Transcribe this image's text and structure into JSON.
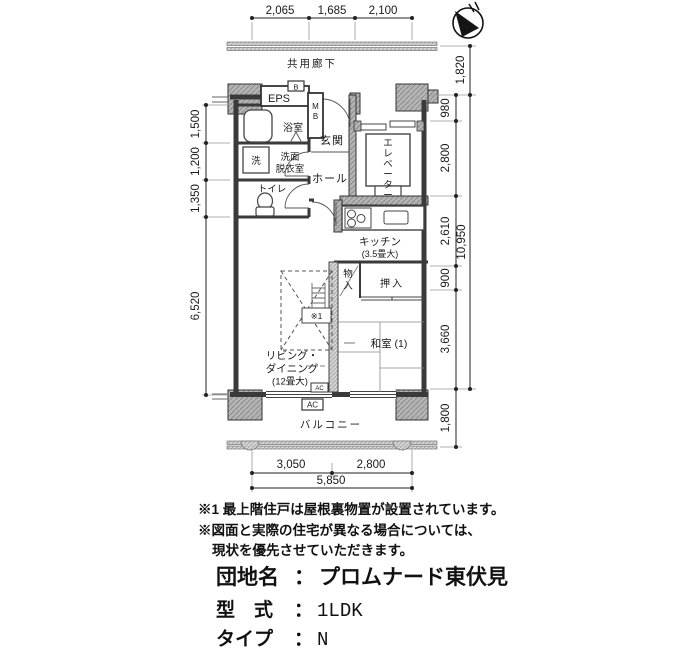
{
  "dims": {
    "top": [
      "2,065",
      "1,685",
      "2,100"
    ],
    "left": [
      "1,500",
      "1,200",
      "1,350",
      "6,520"
    ],
    "right_inner": [
      "980",
      "2,800",
      "2,610",
      "900",
      "3,660",
      "1,800"
    ],
    "right_outer": [
      "1,820",
      "10,950"
    ],
    "bottom": [
      "3,050",
      "2,800"
    ],
    "bottom_total": "5,850"
  },
  "plan": {
    "corridor": "共用廊下",
    "balcony": "バルコニー",
    "eps": "EPS",
    "meter_b": "B",
    "mb": "MB",
    "bath": "浴室",
    "wash_machine": "洗",
    "washroom": [
      "洗面",
      "脱衣室"
    ],
    "toilet": "トイレ",
    "entrance": "玄関",
    "hall": "ホール",
    "elevator": "エレベーター",
    "kitchen": "キッチン",
    "kitchen_size": "(3.5畳大)",
    "storage": "物入",
    "closet": "押入",
    "japanese_room": "和室 (1)",
    "living": [
      "リビング・",
      "ダイニング"
    ],
    "living_size": "(12畳大)",
    "ac": "AC",
    "note_ref": "※1"
  },
  "notes": [
    "※1 最上階住戸は屋根裏物置が設置されています。",
    "※図面と実際の住宅が異なる場合については、",
    "現状を優先させていただきます。"
  ],
  "info": {
    "rows": [
      {
        "label": "団地名",
        "sep": "：",
        "value": "プロムナード東伏見"
      },
      {
        "label": "型　式",
        "sep": "：",
        "value": "1LDK"
      },
      {
        "label": "タイプ",
        "sep": "：",
        "value": "N"
      },
      {
        "label": "図面No",
        "sep": "：",
        "value": "20549"
      }
    ]
  }
}
